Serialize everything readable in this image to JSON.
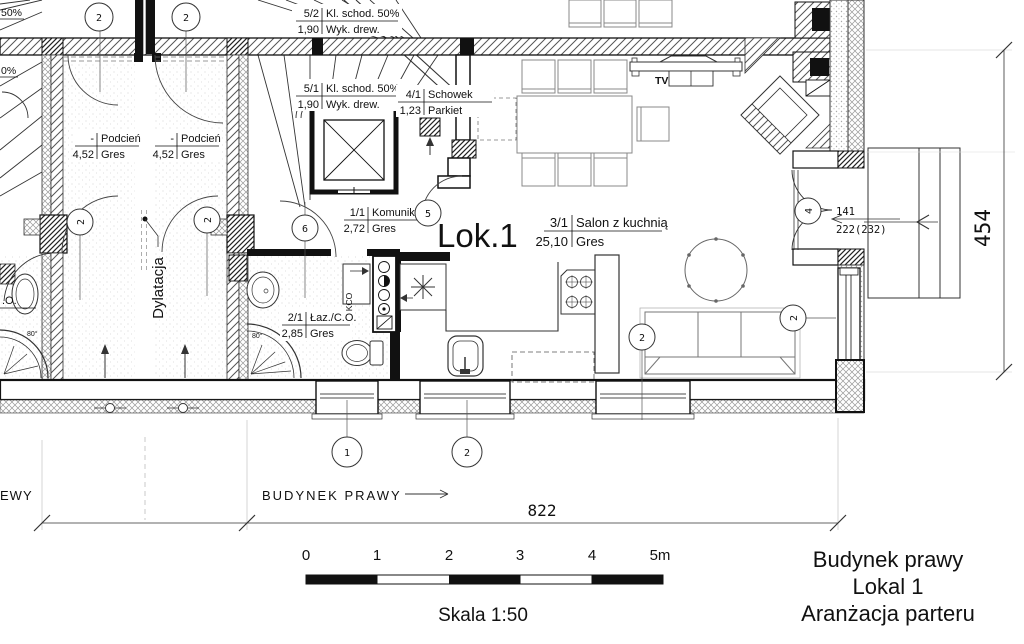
{
  "unit_label": "Lok.1",
  "rooms": {
    "kl_schod_2": {
      "id": "5/2",
      "name": "Kl. schod. 50%",
      "area": "1,90",
      "floor": "Wyk. drew."
    },
    "kl_schod_1": {
      "id": "5/1",
      "name": "Kl. schod. 50%",
      "area": "1,90",
      "floor": "Wyk. drew."
    },
    "schowek": {
      "id": "4/1",
      "name": "Schowek",
      "area": "1,23",
      "floor": "Parkiet"
    },
    "komunikacja": {
      "id": "1/1",
      "name": "Komunikacja",
      "area": "2,72",
      "floor": "Gres"
    },
    "salon": {
      "id": "3/1",
      "name": "Salon z kuchnią",
      "area": "25,10",
      "floor": "Gres"
    },
    "lazienka": {
      "id": "2/1",
      "name": "Łaz./C.O.",
      "area": "2,85",
      "floor": "Gres"
    },
    "podcien_left": {
      "id": "-",
      "name": "Podcień",
      "area": "4,52",
      "floor": "Gres"
    },
    "podcien_right": {
      "id": "-",
      "name": "Podcień",
      "area": "4,52",
      "floor": "Gres"
    }
  },
  "annotations": {
    "dylatacja": "Dylatacja",
    "tv": "TV",
    "kco": "KCO",
    "shower_angle_right": "80°",
    "shower_angle_left": "80°",
    "partial_co": ".O.",
    "partial_stair_upper": "50%",
    "partial_stair_lower": "0%",
    "building_right": "BUDYNEK PRAWY",
    "building_left_partial": "EWY"
  },
  "markers": {
    "top_door_left": "2",
    "top_door_right": "2",
    "entry_left": "2",
    "entry_right": "2",
    "komunikacja_door": "6",
    "schowek_door": "5",
    "terrace_door": "4",
    "sofa_left": "2",
    "sofa_right": "2",
    "window_1": "1",
    "window_2": "2"
  },
  "dimensions": {
    "total_width": "822",
    "total_height": "454",
    "door_width": "141",
    "door_height": "222(232)"
  },
  "scale_bar": {
    "ticks": [
      "0",
      "1",
      "2",
      "3",
      "4",
      "5m"
    ],
    "label": "Skala 1:50"
  },
  "title_block": {
    "line1": "Budynek prawy",
    "line2": "Lokal 1",
    "line3": "Aranżacja parteru"
  }
}
